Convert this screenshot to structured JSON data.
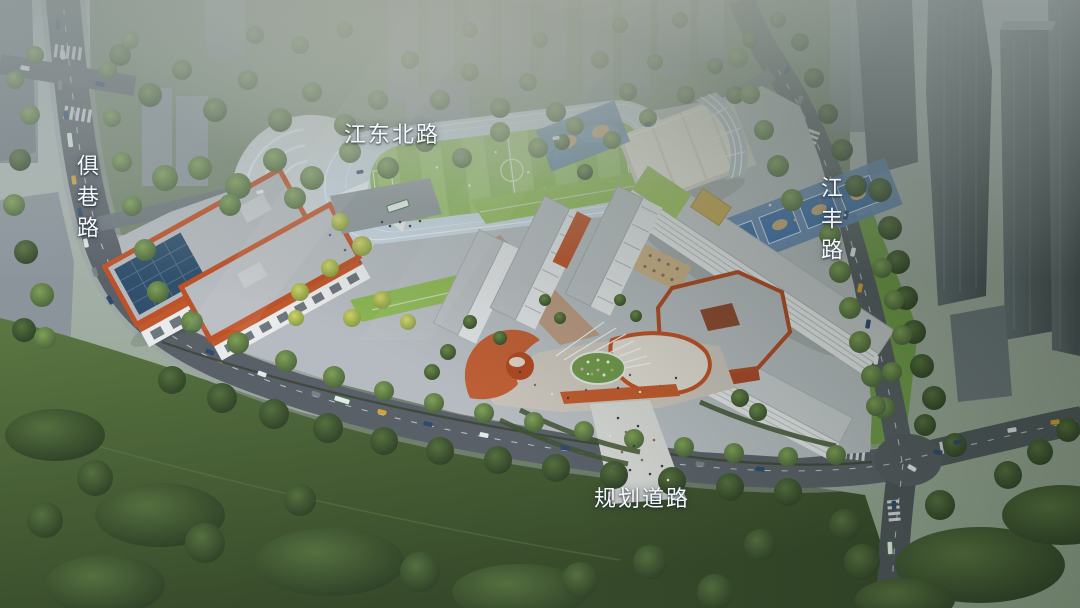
{
  "road_labels": {
    "north": {
      "text": "江东北路",
      "orientation": "horizontal"
    },
    "west": {
      "text": "俱巷路",
      "orientation": "vertical"
    },
    "east": {
      "text": "江丰路",
      "orientation": "vertical"
    },
    "south": {
      "text": "规划道路",
      "orientation": "horizontal"
    }
  },
  "colors": {
    "label_text": "#f4f7f9",
    "running_track": "#c9d8e5",
    "sports_field": "#8cb85a",
    "basketball_court": "#3d6dac",
    "court_center": "#c9a878",
    "building_terracotta": "#c05a2e",
    "building_white": "#e8eaec",
    "solar_panel": "#30506d",
    "roof_garden": "#93be59",
    "asphalt": "#596068",
    "meadow": "#4e6839",
    "tree_canopy": "#466038",
    "background_tower": "#808b94"
  }
}
